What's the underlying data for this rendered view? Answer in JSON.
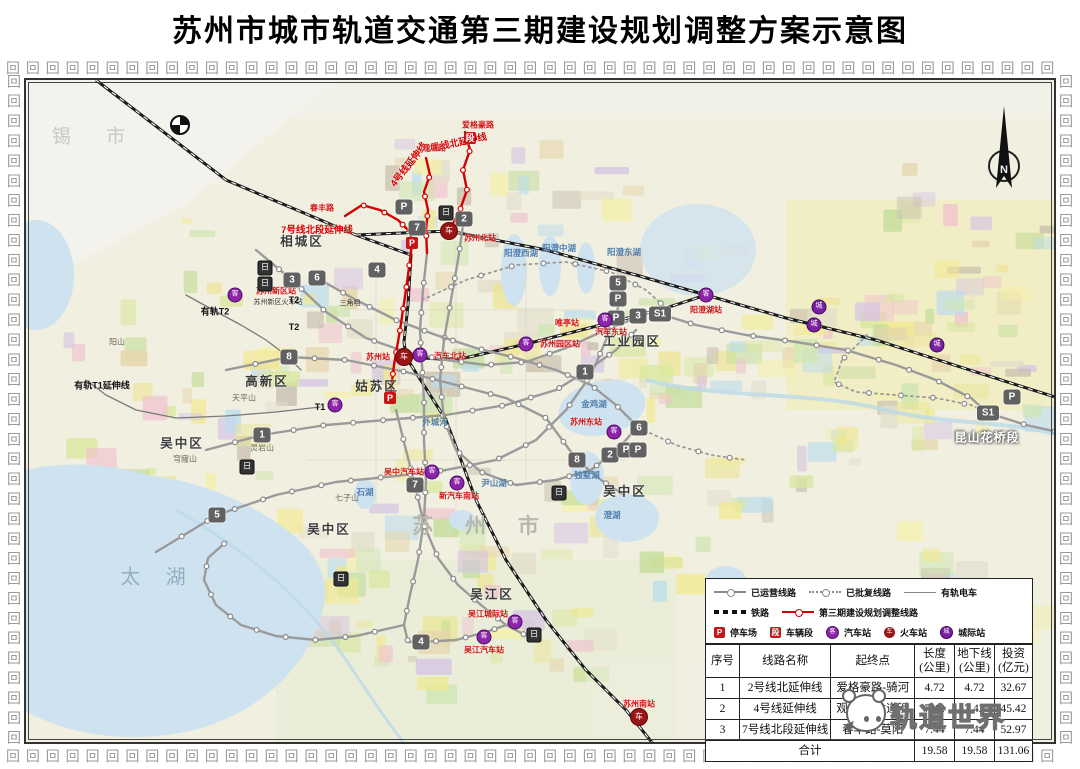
{
  "title": "苏州市城市轨道交通第三期建设规划调整方案示意图",
  "compass_label": "N",
  "watermark": {
    "text": "轨道世界"
  },
  "legend": {
    "rows": [
      [
        {
          "key": "operating",
          "label": "已运营线路"
        },
        {
          "key": "approved",
          "label": "已批复线路"
        },
        {
          "key": "tram",
          "label": "有轨电车"
        }
      ],
      [
        {
          "key": "railway",
          "label": "铁路"
        },
        {
          "key": "phase3",
          "label": "第三期建设规划调整线路"
        }
      ],
      [
        {
          "key": "depot-p",
          "glyph": "P",
          "label": "停车场"
        },
        {
          "key": "depot-d",
          "glyph": "段",
          "label": "车辆段"
        },
        {
          "key": "bus",
          "glyph": "客",
          "label": "汽车站"
        },
        {
          "key": "train",
          "glyph": "车",
          "label": "火车站"
        },
        {
          "key": "inter",
          "glyph": "城",
          "label": "城际站"
        }
      ]
    ]
  },
  "table": {
    "headers": [
      "序号",
      "线路名称",
      "起终点",
      "长度\n(公里)",
      "地下线\n(公里)",
      "投资\n(亿元)"
    ],
    "rows": [
      [
        "1",
        "2号线北延伸线",
        "爱格豪路-骑河",
        "4.72",
        "4.72",
        "32.67"
      ],
      [
        "2",
        "4号线延伸线",
        "观塘路-龙道浜",
        "7.42",
        "7.42",
        "45.42"
      ],
      [
        "3",
        "7号线北段延伸线",
        "春丰路-莫阳",
        "7.44",
        "7.44",
        "52.97"
      ]
    ],
    "total_label": "合计",
    "total": [
      "19.58",
      "19.58",
      "131.06"
    ]
  },
  "map": {
    "district_labels": [
      {
        "text": "相城区",
        "x": 276,
        "y": 160
      },
      {
        "text": "姑苏区",
        "x": 351,
        "y": 305
      },
      {
        "text": "高新区",
        "x": 241,
        "y": 300
      },
      {
        "text": "工业园区",
        "x": 606,
        "y": 260
      },
      {
        "text": "吴中区",
        "x": 156,
        "y": 362
      },
      {
        "text": "吴中区",
        "x": 303,
        "y": 448
      },
      {
        "text": "吴中区",
        "x": 599,
        "y": 410
      },
      {
        "text": "吴江区",
        "x": 466,
        "y": 513
      }
    ],
    "city_label": {
      "text": "苏 州 市",
      "x": 456,
      "y": 445
    },
    "xi_label": {
      "text": "锡 市",
      "x": 70,
      "y": 55
    },
    "taihu_label": {
      "text": "太 湖",
      "x": 132,
      "y": 495
    },
    "section_label": {
      "text": "昆山花桥段",
      "x": 961,
      "y": 357
    },
    "lake_labels": [
      {
        "text": "金鸡湖",
        "x": 568,
        "y": 324
      },
      {
        "text": "阳澄西湖",
        "x": 495,
        "y": 173
      },
      {
        "text": "阳澄中湖",
        "x": 533,
        "y": 168
      },
      {
        "text": "阳澄东湖",
        "x": 598,
        "y": 172
      },
      {
        "text": "独墅湖",
        "x": 561,
        "y": 395
      },
      {
        "text": "石湖",
        "x": 339,
        "y": 412
      },
      {
        "text": "尹山湖",
        "x": 468,
        "y": 403
      },
      {
        "text": "澄湖",
        "x": 586,
        "y": 435
      },
      {
        "text": "外城河",
        "x": 409,
        "y": 342
      }
    ],
    "mountain_labels": [
      {
        "text": "阳山",
        "x": 91,
        "y": 262
      },
      {
        "text": "天平山",
        "x": 218,
        "y": 318
      },
      {
        "text": "灵岩山",
        "x": 236,
        "y": 368
      },
      {
        "text": "穹窿山",
        "x": 159,
        "y": 379
      },
      {
        "text": "七子山",
        "x": 321,
        "y": 418
      }
    ],
    "red_line_labels": [
      {
        "text": "2号线北延伸线",
        "x": 430,
        "y": 62,
        "rot": -12
      },
      {
        "text": "4号线延伸线",
        "x": 382,
        "y": 84,
        "rot": -52
      },
      {
        "text": "7号线北段延伸线",
        "x": 291,
        "y": 149,
        "rot": 0
      }
    ],
    "red_station_labels": [
      {
        "text": "苏州北站",
        "x": 454,
        "y": 158
      },
      {
        "text": "苏州站",
        "x": 352,
        "y": 277
      },
      {
        "text": "苏州园区站",
        "x": 534,
        "y": 264
      },
      {
        "text": "汽车北站",
        "x": 424,
        "y": 276
      },
      {
        "text": "唯亭站",
        "x": 541,
        "y": 243
      },
      {
        "text": "汽车东站",
        "x": 585,
        "y": 252
      },
      {
        "text": "阳澄湖站",
        "x": 680,
        "y": 230
      },
      {
        "text": "苏州东站",
        "x": 560,
        "y": 342
      },
      {
        "text": "新汽车南站",
        "x": 433,
        "y": 416
      },
      {
        "text": "吴中汽车站",
        "x": 378,
        "y": 392
      },
      {
        "text": "吴江城际站",
        "x": 462,
        "y": 534
      },
      {
        "text": "吴江汽车站",
        "x": 458,
        "y": 570
      },
      {
        "text": "苏州南站",
        "x": 613,
        "y": 624
      },
      {
        "text": "苏州新区站",
        "x": 250,
        "y": 211
      },
      {
        "text": "爱格豪路",
        "x": 452,
        "y": 45
      },
      {
        "text": "观塘路",
        "x": 408,
        "y": 68
      },
      {
        "text": "春丰路",
        "x": 296,
        "y": 128
      }
    ],
    "black_tiny_labels": [
      {
        "text": "苏州新区火车站",
        "x": 252,
        "y": 222
      },
      {
        "text": "三角咀",
        "x": 324,
        "y": 223
      }
    ],
    "tram_labels": [
      {
        "text": "有轨T1延伸线",
        "x": 76,
        "y": 305
      },
      {
        "text": "有轨T2",
        "x": 189,
        "y": 231
      },
      {
        "text": "T2",
        "x": 268,
        "y": 220
      },
      {
        "text": "T2",
        "x": 268,
        "y": 247
      },
      {
        "text": "T1",
        "x": 294,
        "y": 327
      }
    ],
    "line_badges": [
      {
        "text": "7",
        "x": 391,
        "y": 148
      },
      {
        "text": "2",
        "x": 438,
        "y": 139
      },
      {
        "text": "4",
        "x": 351,
        "y": 190
      },
      {
        "text": "5",
        "x": 592,
        "y": 203
      },
      {
        "text": "3",
        "x": 266,
        "y": 200
      },
      {
        "text": "6",
        "x": 291,
        "y": 198
      },
      {
        "text": "8",
        "x": 263,
        "y": 277
      },
      {
        "text": "1",
        "x": 236,
        "y": 355
      },
      {
        "text": "1",
        "x": 559,
        "y": 292
      },
      {
        "text": "3",
        "x": 612,
        "y": 236
      },
      {
        "text": "S1",
        "x": 634,
        "y": 234
      },
      {
        "text": "P",
        "x": 592,
        "y": 219
      },
      {
        "text": "P",
        "x": 590,
        "y": 238
      },
      {
        "text": "6",
        "x": 613,
        "y": 348
      },
      {
        "text": "8",
        "x": 551,
        "y": 380
      },
      {
        "text": "2",
        "x": 584,
        "y": 375
      },
      {
        "text": "P",
        "x": 600,
        "y": 370
      },
      {
        "text": "P",
        "x": 612,
        "y": 370
      },
      {
        "text": "7",
        "x": 389,
        "y": 405
      },
      {
        "text": "5",
        "x": 191,
        "y": 435
      },
      {
        "text": "4",
        "x": 395,
        "y": 562
      },
      {
        "text": "S1",
        "x": 962,
        "y": 333
      },
      {
        "text": "P",
        "x": 986,
        "y": 317
      },
      {
        "text": "P",
        "x": 378,
        "y": 127
      }
    ],
    "red_squares": [
      {
        "text": "P",
        "x": 386,
        "y": 163
      },
      {
        "text": "P",
        "x": 364,
        "y": 318
      },
      {
        "text": "段",
        "x": 444,
        "y": 58
      }
    ],
    "train_squares": [
      {
        "x": 239,
        "y": 188
      },
      {
        "x": 239,
        "y": 204
      },
      {
        "x": 420,
        "y": 133
      },
      {
        "x": 533,
        "y": 413
      },
      {
        "x": 508,
        "y": 555
      },
      {
        "x": 221,
        "y": 387
      },
      {
        "x": 315,
        "y": 499
      }
    ],
    "bus_stations": [
      {
        "x": 209,
        "y": 215
      },
      {
        "x": 394,
        "y": 275
      },
      {
        "x": 500,
        "y": 264
      },
      {
        "x": 579,
        "y": 240
      },
      {
        "x": 680,
        "y": 215
      },
      {
        "x": 588,
        "y": 352
      },
      {
        "x": 431,
        "y": 403
      },
      {
        "x": 406,
        "y": 392
      },
      {
        "x": 489,
        "y": 542
      },
      {
        "x": 458,
        "y": 557
      },
      {
        "x": 309,
        "y": 325
      }
    ],
    "intercity_stations": [
      {
        "x": 793,
        "y": 227
      },
      {
        "x": 788,
        "y": 245
      },
      {
        "x": 911,
        "y": 265
      }
    ],
    "train_stations": [
      {
        "x": 423,
        "y": 151
      },
      {
        "x": 378,
        "y": 277
      },
      {
        "x": 613,
        "y": 637
      }
    ]
  }
}
